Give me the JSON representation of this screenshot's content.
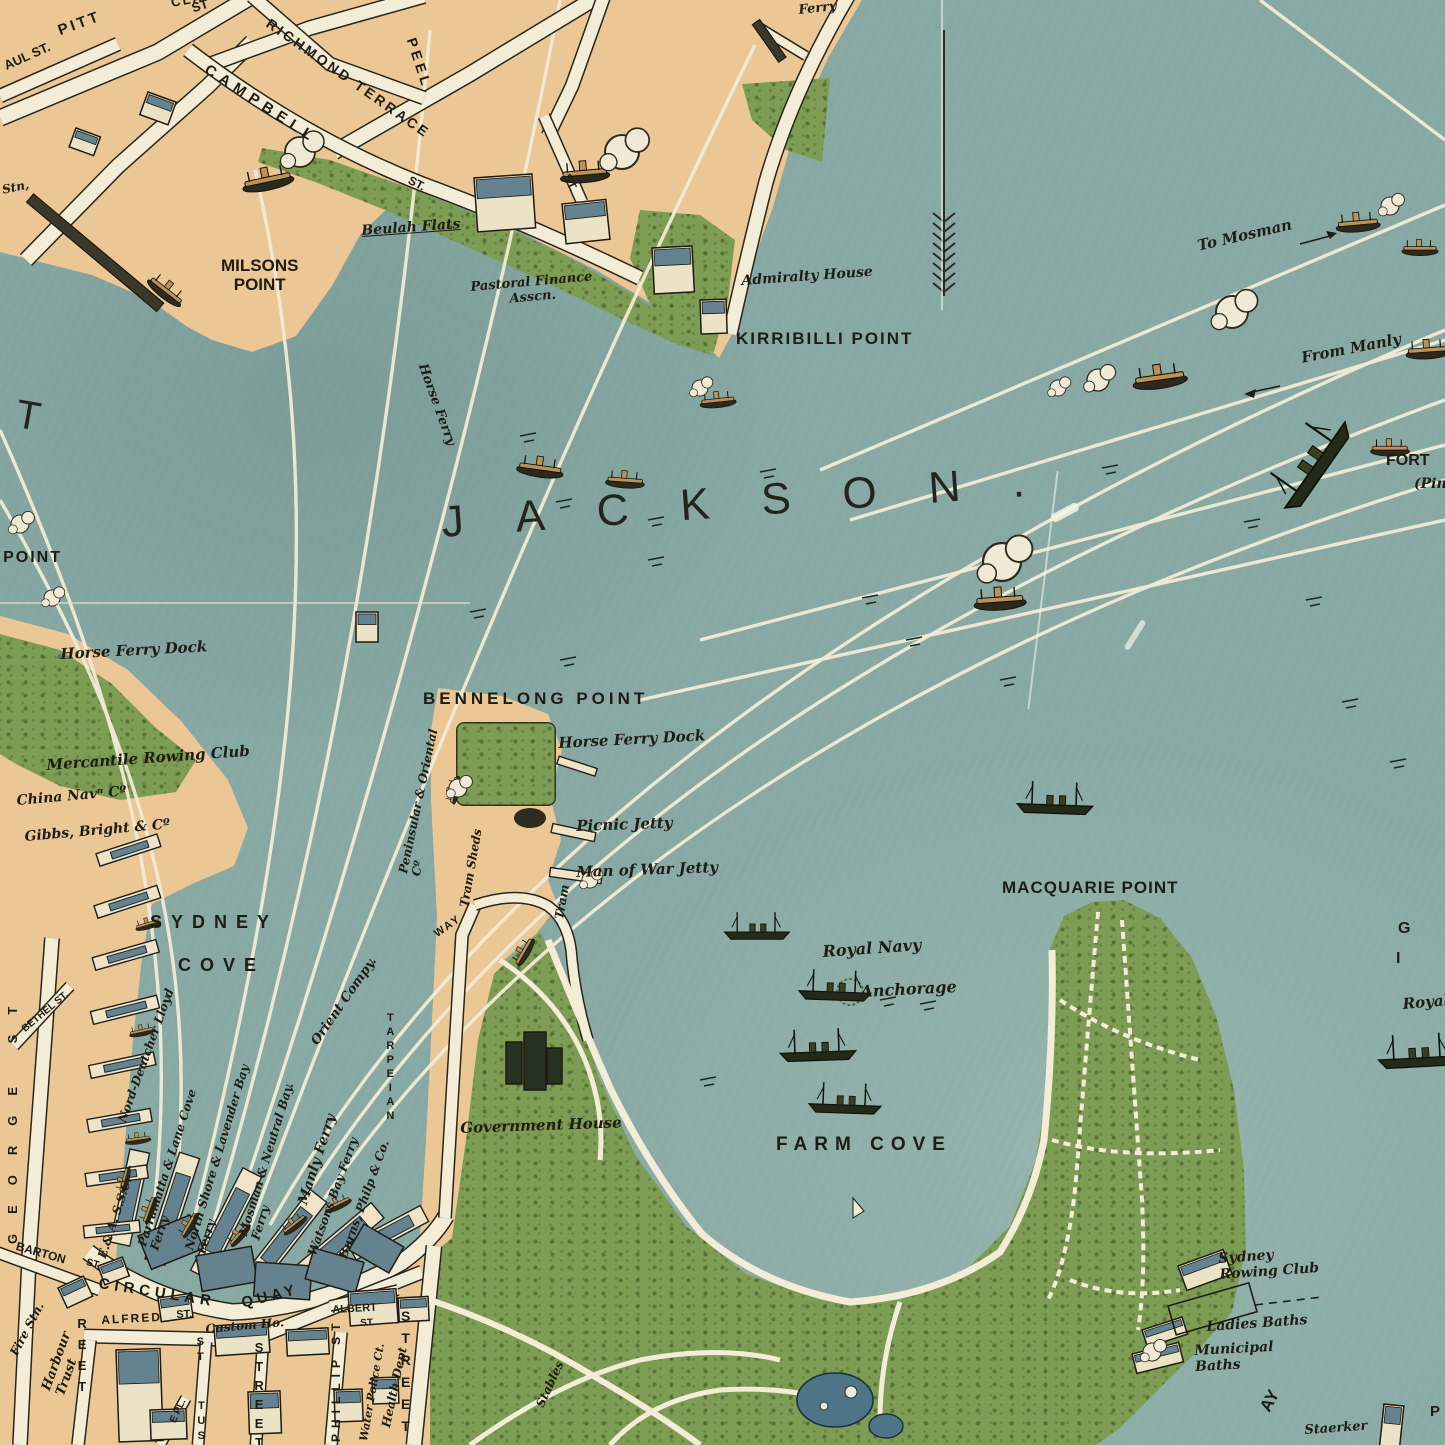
{
  "palette": {
    "water": "#87a8a3",
    "land": "#ebc795",
    "vegetation": "#7e9d54",
    "street": "#f3ecd6",
    "ink": "#1e1d13",
    "route_line": "#f1ebd6",
    "roof": "#64828f",
    "pond": "#4e7587"
  },
  "map": {
    "water_body_label": "JACKSON.",
    "compass": "north-arrow"
  },
  "labels": [
    {
      "t": "PITT",
      "x": 56,
      "y": 24,
      "r": -20,
      "c": "st",
      "s": 15,
      "ls": 3
    },
    {
      "t": "ST",
      "x": 190,
      "y": 2,
      "r": -18,
      "c": "st",
      "s": 13
    },
    {
      "t": "AUL ST.",
      "x": 2,
      "y": 60,
      "r": -24,
      "c": "st",
      "s": 13
    },
    {
      "t": "CLAPHAM RISE",
      "x": 170,
      "y": -4,
      "r": -10,
      "c": "st",
      "s": 13,
      "ls": 2
    },
    {
      "t": "RICHMOND TERRACE",
      "x": 272,
      "y": 16,
      "r": 35,
      "c": "st",
      "s": 14,
      "ls": 3
    },
    {
      "t": "PEEL",
      "x": 418,
      "y": 36,
      "r": 72,
      "c": "st",
      "s": 14,
      "ls": 4
    },
    {
      "t": "CAMPBELL",
      "x": 210,
      "y": 62,
      "r": 33,
      "c": "st",
      "s": 15,
      "ls": 6
    },
    {
      "t": "ST.",
      "x": 412,
      "y": 174,
      "r": 28,
      "c": "st",
      "s": 12
    },
    {
      "t": "ST.",
      "x": 572,
      "y": 172,
      "r": 64,
      "c": "st",
      "s": 12
    },
    {
      "t": "Stn,",
      "x": 1,
      "y": 184,
      "r": -12,
      "c": "scr",
      "s": 12
    },
    {
      "t": "Beulah Flats",
      "x": 361,
      "y": 224,
      "r": -4,
      "c": "scr",
      "s": 14,
      "u": 1
    },
    {
      "t": "MILSONS\nPOINT",
      "x": 221,
      "y": 256,
      "r": 0,
      "c": "cap",
      "s": 17,
      "ctr": 1
    },
    {
      "t": "Pastoral Finance\nAsscn.",
      "x": 470,
      "y": 281,
      "r": -5,
      "c": "scr",
      "s": 13,
      "ctr": 1
    },
    {
      "t": "Admiralty House",
      "x": 741,
      "y": 274,
      "r": -4,
      "c": "scr",
      "s": 14
    },
    {
      "t": "KIRRIBILLI POINT",
      "x": 736,
      "y": 329,
      "r": 0,
      "c": "cap",
      "s": 17,
      "ls": 2
    },
    {
      "t": "Ferry",
      "x": 798,
      "y": 4,
      "r": -6,
      "c": "scr",
      "s": 13
    },
    {
      "t": "To Mosman",
      "x": 1196,
      "y": 238,
      "r": -13,
      "c": "scr",
      "s": 15
    },
    {
      "t": "From Manly",
      "x": 1300,
      "y": 350,
      "r": -11,
      "c": "scr",
      "s": 15
    },
    {
      "t": "FORT",
      "x": 1386,
      "y": 452,
      "r": 0,
      "c": "cap",
      "s": 16
    },
    {
      "t": "(Pin",
      "x": 1414,
      "y": 477,
      "r": 0,
      "c": "scr",
      "s": 14
    },
    {
      "t": "T",
      "x": 20,
      "y": 392,
      "r": 10,
      "c": "big2",
      "s": 40
    },
    {
      "t": "JACKSON.",
      "x": 440,
      "y": 498,
      "r": -4,
      "c": "big",
      "s": 44,
      "ls": 52
    },
    {
      "t": "Horse Ferry",
      "x": 428,
      "y": 362,
      "r": 70,
      "c": "scr",
      "s": 13
    },
    {
      "t": "S POINT",
      "x": -16,
      "y": 549,
      "r": 0,
      "c": "cap",
      "s": 16,
      "ls": 2
    },
    {
      "t": "Horse Ferry Dock",
      "x": 60,
      "y": 646,
      "r": -3,
      "c": "scr",
      "s": 15
    },
    {
      "t": "Mercantile Rowing Club",
      "x": 46,
      "y": 757,
      "r": -4,
      "c": "scr",
      "s": 15
    },
    {
      "t": "China Navⁿ Cº",
      "x": 16,
      "y": 794,
      "r": -5,
      "c": "scr",
      "s": 14
    },
    {
      "t": "Gibbs, Bright & Cº",
      "x": 24,
      "y": 830,
      "r": -5,
      "c": "scr",
      "s": 14
    },
    {
      "t": "SYDNEY",
      "x": 150,
      "y": 912,
      "r": 0,
      "c": "cap",
      "s": 18,
      "ls": 9
    },
    {
      "t": "COVE",
      "x": 178,
      "y": 955,
      "r": 0,
      "c": "cap",
      "s": 18,
      "ls": 9
    },
    {
      "t": "E.& A. S.S.C.",
      "x": 96,
      "y": 1256,
      "r": -72,
      "c": "pier",
      "s": 12
    },
    {
      "t": "Nord-Deutcher Lloyd",
      "x": 116,
      "y": 1120,
      "r": -70,
      "c": "pier",
      "s": 12
    },
    {
      "t": "Parramatta & Lane Cove\nFerry",
      "x": 136,
      "y": 1244,
      "r": -72,
      "c": "pier",
      "s": 12
    },
    {
      "t": "North Shore & Lavender Bay\nFerry",
      "x": 183,
      "y": 1248,
      "r": -73,
      "c": "pier",
      "s": 12
    },
    {
      "t": "Mosman & Neutral Bay.\nFerry",
      "x": 237,
      "y": 1234,
      "r": -73,
      "c": "pier",
      "s": 12
    },
    {
      "t": "Manly Ferry",
      "x": 296,
      "y": 1202,
      "r": -72,
      "c": "pier",
      "s": 14
    },
    {
      "t": "Watsons Bay Ferry",
      "x": 306,
      "y": 1253,
      "r": -70,
      "c": "pier",
      "s": 12
    },
    {
      "t": "Burns, Philp & Co.",
      "x": 337,
      "y": 1256,
      "r": -70,
      "c": "pier",
      "s": 12
    },
    {
      "t": "Orient Compy.",
      "x": 309,
      "y": 1040,
      "r": -55,
      "c": "pier",
      "s": 13
    },
    {
      "t": "BENNELONG POINT",
      "x": 423,
      "y": 689,
      "r": 0,
      "c": "cap",
      "s": 17,
      "ls": 4
    },
    {
      "t": "Peninsular & Oriental\nCº",
      "x": 397,
      "y": 872,
      "r": -78,
      "c": "pier",
      "s": 12
    },
    {
      "t": "Tram Sheds",
      "x": 458,
      "y": 906,
      "r": -80,
      "c": "pier",
      "s": 12
    },
    {
      "t": "Horse Ferry Dock",
      "x": 558,
      "y": 735,
      "r": -3,
      "c": "scr",
      "s": 15
    },
    {
      "t": "Picnic Jetty",
      "x": 576,
      "y": 818,
      "r": -2,
      "c": "scr",
      "s": 15
    },
    {
      "t": "Man of War Jetty",
      "x": 576,
      "y": 864,
      "r": -2,
      "c": "scr",
      "s": 15
    },
    {
      "t": "Tram",
      "x": 553,
      "y": 918,
      "r": -80,
      "c": "pier",
      "s": 12
    },
    {
      "t": "WAY",
      "x": 432,
      "y": 930,
      "r": -35,
      "c": "st",
      "s": 11,
      "ls": 2
    },
    {
      "t": "TARPEIAN",
      "x": 384,
      "y": 1012,
      "r": 0,
      "c": "vst",
      "s": 11,
      "ls": 2
    },
    {
      "t": "Government House",
      "x": 460,
      "y": 1120,
      "r": -2,
      "c": "scr",
      "s": 15
    },
    {
      "t": "FARM COVE",
      "x": 776,
      "y": 1134,
      "r": 0,
      "c": "cap",
      "s": 19,
      "ls": 7
    },
    {
      "t": "MACQUARIE POINT",
      "x": 1002,
      "y": 878,
      "r": 0,
      "c": "cap",
      "s": 17,
      "ls": 1
    },
    {
      "t": "Royal Navy",
      "x": 822,
      "y": 943,
      "r": -4,
      "c": "scr",
      "s": 16
    },
    {
      "t": "Anchorage",
      "x": 860,
      "y": 983,
      "r": -3,
      "c": "scr",
      "s": 16
    },
    {
      "t": "G",
      "x": 1398,
      "y": 920,
      "r": 0,
      "c": "cap",
      "s": 16
    },
    {
      "t": "I",
      "x": 1396,
      "y": 950,
      "r": 0,
      "c": "cap",
      "s": 16
    },
    {
      "t": "Royal",
      "x": 1402,
      "y": 996,
      "r": -5,
      "c": "scr",
      "s": 15
    },
    {
      "t": "Sydney\nRowing Club",
      "x": 1218,
      "y": 1252,
      "r": -4,
      "c": "scr",
      "s": 14
    },
    {
      "t": "Ladies Baths",
      "x": 1206,
      "y": 1320,
      "r": -4,
      "c": "scr",
      "s": 14
    },
    {
      "t": "Municipal\nBaths",
      "x": 1194,
      "y": 1344,
      "r": -3,
      "c": "scr",
      "s": 14
    },
    {
      "t": "AY",
      "x": 1256,
      "y": 1406,
      "r": -62,
      "c": "cap",
      "s": 17
    },
    {
      "t": "Staerker",
      "x": 1304,
      "y": 1424,
      "r": -4,
      "c": "scr",
      "s": 13
    },
    {
      "t": "P",
      "x": 1430,
      "y": 1404,
      "r": 0,
      "c": "cap",
      "s": 15
    },
    {
      "t": "CIRCULAR",
      "x": 100,
      "y": 1276,
      "r": 9,
      "c": "cap",
      "s": 15,
      "ls": 5
    },
    {
      "t": "QUAY",
      "x": 240,
      "y": 1296,
      "r": -14,
      "c": "cap",
      "s": 15,
      "ls": 4
    },
    {
      "t": "ALFRED",
      "x": 101,
      "y": 1314,
      "r": -3,
      "c": "st",
      "s": 12,
      "ls": 2
    },
    {
      "t": "ST.",
      "x": 176,
      "y": 1309,
      "r": -3,
      "c": "st",
      "s": 11
    },
    {
      "t": "BARTON",
      "x": 18,
      "y": 1240,
      "r": 16,
      "c": "st",
      "s": 12
    },
    {
      "t": "ST",
      "x": 88,
      "y": 1257,
      "r": 16,
      "c": "st",
      "s": 10
    },
    {
      "t": "Fire Stn.",
      "x": 8,
      "y": 1352,
      "r": -62,
      "c": "pier",
      "s": 12
    },
    {
      "t": "Harbour\nTrust",
      "x": 40,
      "y": 1388,
      "r": -70,
      "c": "pier",
      "s": 13
    },
    {
      "t": "GEORGE ST",
      "x": 6,
      "y": 1244,
      "r": -90,
      "c": "st",
      "s": 13,
      "ls": 20
    },
    {
      "t": "BETHEL ST.",
      "x": 20,
      "y": 1026,
      "r": -40,
      "c": "st",
      "s": 10
    },
    {
      "t": "Custom Ho.",
      "x": 205,
      "y": 1323,
      "r": -5,
      "c": "scr",
      "s": 12
    },
    {
      "t": "ALBERT",
      "x": 332,
      "y": 1304,
      "r": -3,
      "c": "st",
      "s": 11
    },
    {
      "t": "ST.",
      "x": 360,
      "y": 1318,
      "r": -3,
      "c": "st",
      "s": 10
    },
    {
      "t": "PHILLIP ST",
      "x": 330,
      "y": 1442,
      "r": -90,
      "c": "st",
      "s": 12,
      "ls": 6
    },
    {
      "t": "Water Police Ct.",
      "x": 358,
      "y": 1440,
      "r": -80,
      "c": "pier",
      "s": 11
    },
    {
      "t": "Health Dept",
      "x": 380,
      "y": 1426,
      "r": -78,
      "c": "pier",
      "s": 12
    },
    {
      "t": "REET",
      "x": 74,
      "y": 1316,
      "r": 0,
      "c": "vst",
      "s": 13,
      "ls": 6
    },
    {
      "t": "ST",
      "x": 194,
      "y": 1336,
      "r": 0,
      "c": "vst",
      "s": 11,
      "ls": 3
    },
    {
      "t": "TUS",
      "x": 195,
      "y": 1400,
      "r": 0,
      "c": "vst",
      "s": 11,
      "ls": 3
    },
    {
      "t": "STREET",
      "x": 251,
      "y": 1340,
      "r": 0,
      "c": "vst",
      "s": 13,
      "ls": 4
    },
    {
      "t": "STREET",
      "x": 397,
      "y": 1308,
      "r": 0,
      "c": "vst",
      "s": 14,
      "ls": 6
    },
    {
      "t": "Stables",
      "x": 534,
      "y": 1404,
      "r": -65,
      "c": "pier",
      "s": 12
    },
    {
      "t": "E PL.",
      "x": 168,
      "y": 1420,
      "r": -65,
      "c": "st",
      "s": 10
    }
  ]
}
